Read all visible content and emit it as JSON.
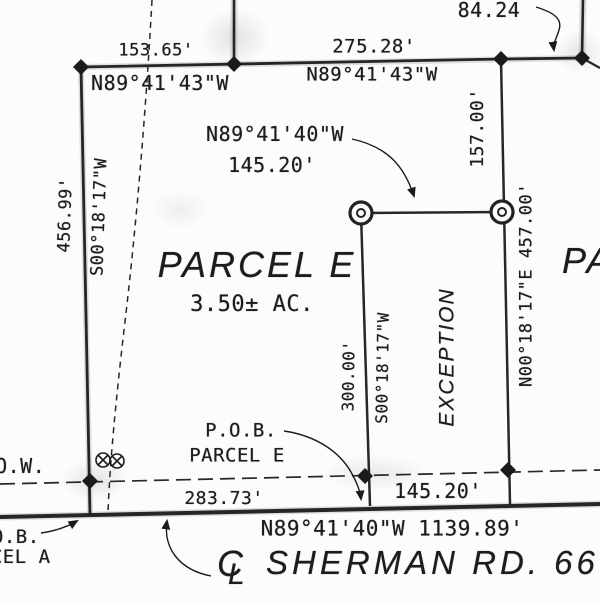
{
  "drawing": {
    "parcel_label": "PARCEL E",
    "parcel_area": "3.50± AC.",
    "exception_label": "EXCEPTION",
    "adjacent_parcel_partial": "PA",
    "road_name": "SHERMAN RD. 66'",
    "row_label": "R.O.W.",
    "centerline_symbol": {
      "c": "C",
      "l": "L"
    }
  },
  "dimensions": {
    "top_left": {
      "distance": "153.65'",
      "bearing": "N89°41'43\"W"
    },
    "top_mid": {
      "distance": "275.28'",
      "bearing": "N89°41'43\"W"
    },
    "top_right_distance": "84.24",
    "west": {
      "distance": "456.99'",
      "bearing": "S00°18'17\"W"
    },
    "east_upper_distance": "157.00'",
    "east_line": "N00°18'17\"E 457.00'",
    "exception_north": {
      "bearing": "N89°41'40\"W",
      "distance": "145.20'"
    },
    "exception_west": {
      "distance": "300.00'",
      "bearing": "S00°18'17\"W"
    },
    "road_seg_left": "283.73'",
    "road_seg_mid": "145.20'",
    "road_line": "N89°41'40\"W 1139.89'"
  },
  "annotations": {
    "pob_e": {
      "line1": "P.O.B.",
      "line2": "PARCEL E"
    },
    "pob_a": {
      "line1": "P.O.B.",
      "line2": "PARCEL A"
    }
  },
  "colors": {
    "ink": "#1b1b1b",
    "paper": "#fcfcfa"
  }
}
